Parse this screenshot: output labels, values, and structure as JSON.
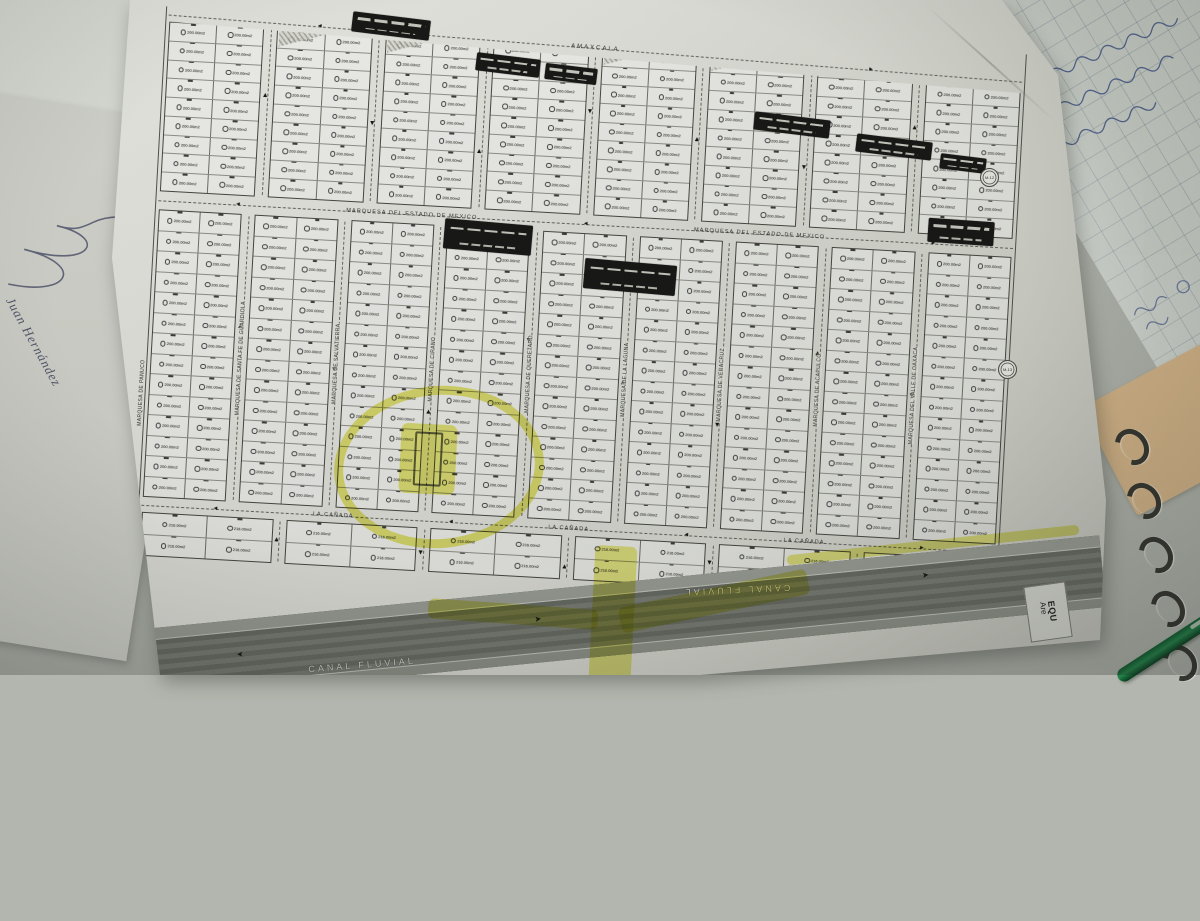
{
  "scene": {
    "signatory": "Juan Hernández",
    "ink_color": "#3f5286",
    "pen_color": "#1d7a3f",
    "folder_color": "#d8b78a",
    "desk_color": "#b2b6ae",
    "spiral_ring_count": 5
  },
  "map": {
    "sheet_color": "#e6e6e0",
    "canal_color": "#70746c",
    "highlight_color": "#e0e032",
    "lot_area_label": "200.00m2",
    "lot_area_label_bottom": "216.00m2",
    "arrows": {
      "left": "◄",
      "right": "►",
      "up": "▲",
      "down": "▼"
    },
    "street_outer_left": "MARQUESA DE PANUCO",
    "streets_vertical_inner": [
      "MARQUESA DE SANTA FE DE GUARDIOLA",
      "MARQUESA DE SALVATIERRA",
      "MARQUESA DE CIRANO",
      "MARQUESA DE QUERETARO",
      "MARQUESA DE LA LAGUNA",
      "MARQUESA DE VERACRUZ",
      "MARQUESA DE ACAPULCO",
      "MARQUESA DEL VALLE DE OAXACA"
    ],
    "h_streets": [
      {
        "labels": [
          "AMAXCALA"
        ]
      },
      {
        "labels": [
          "MARQUESA DEL ESTADO DE MEXICO",
          "MARQUESA DEL ESTADO DE MEXICO"
        ]
      },
      {
        "labels": [
          "LA CAÑADA",
          "LA CAÑADA",
          "LA CAÑADA"
        ]
      }
    ],
    "canal_label": "CANAL FLUVIAL",
    "equip": {
      "line1": "EQU",
      "line2": "Are"
    },
    "bands": [
      {
        "blocks": 8,
        "lot_rows": 9,
        "height": 170,
        "lot_label": "200.00m2"
      },
      {
        "blocks": 9,
        "lot_rows": 14,
        "height": 288,
        "lot_label": "200.00m2"
      },
      {
        "blocks": 6,
        "lot_rows": 2,
        "height": 44,
        "lot_label": "216.00m2"
      }
    ],
    "hatched_blocks": [
      1,
      2,
      4,
      5,
      7
    ],
    "black_banners": [
      {
        "x": 352,
        "y": 16,
        "w": 78,
        "h": 20,
        "r": 7
      },
      {
        "x": 476,
        "y": 56,
        "w": 64,
        "h": 18,
        "r": 7
      },
      {
        "x": 545,
        "y": 66,
        "w": 52,
        "h": 16,
        "r": 7
      },
      {
        "x": 754,
        "y": 116,
        "w": 76,
        "h": 18,
        "r": 7
      },
      {
        "x": 856,
        "y": 138,
        "w": 76,
        "h": 18,
        "r": 7
      },
      {
        "x": 940,
        "y": 156,
        "w": 46,
        "h": 15,
        "r": 7
      },
      {
        "x": 444,
        "y": 222,
        "w": 88,
        "h": 30,
        "r": 5
      },
      {
        "x": 584,
        "y": 262,
        "w": 92,
        "h": 30,
        "r": 5
      },
      {
        "x": 928,
        "y": 220,
        "w": 66,
        "h": 24,
        "r": 4
      }
    ],
    "yellow_roads": [
      {
        "x": 592,
        "y": 546,
        "w": 42,
        "h": 134,
        "r": 3
      },
      {
        "x": 428,
        "y": 604,
        "w": 170,
        "h": 20,
        "r": 4
      },
      {
        "x": 618,
        "y": 588,
        "w": 192,
        "h": 26,
        "r": -12
      },
      {
        "x": 786,
        "y": 540,
        "w": 294,
        "h": 10,
        "r": -6
      }
    ],
    "highlight_circle": {
      "x": 334,
      "y": 386,
      "w": 192,
      "h": 144,
      "r": -5
    },
    "highlight_blob": {
      "x": 400,
      "y": 424,
      "w": 56,
      "h": 70,
      "r": 3
    },
    "coordinate_ticks": [
      {
        "x": 56,
        "y": 158,
        "label": "+ 368.800"
      },
      {
        "x": 40,
        "y": 352,
        "label": "+ 368.600"
      }
    ],
    "circle_markers": [
      {
        "x": 980,
        "y": 168,
        "label": "M-12"
      },
      {
        "x": 998,
        "y": 360,
        "label": "M-13"
      }
    ]
  }
}
